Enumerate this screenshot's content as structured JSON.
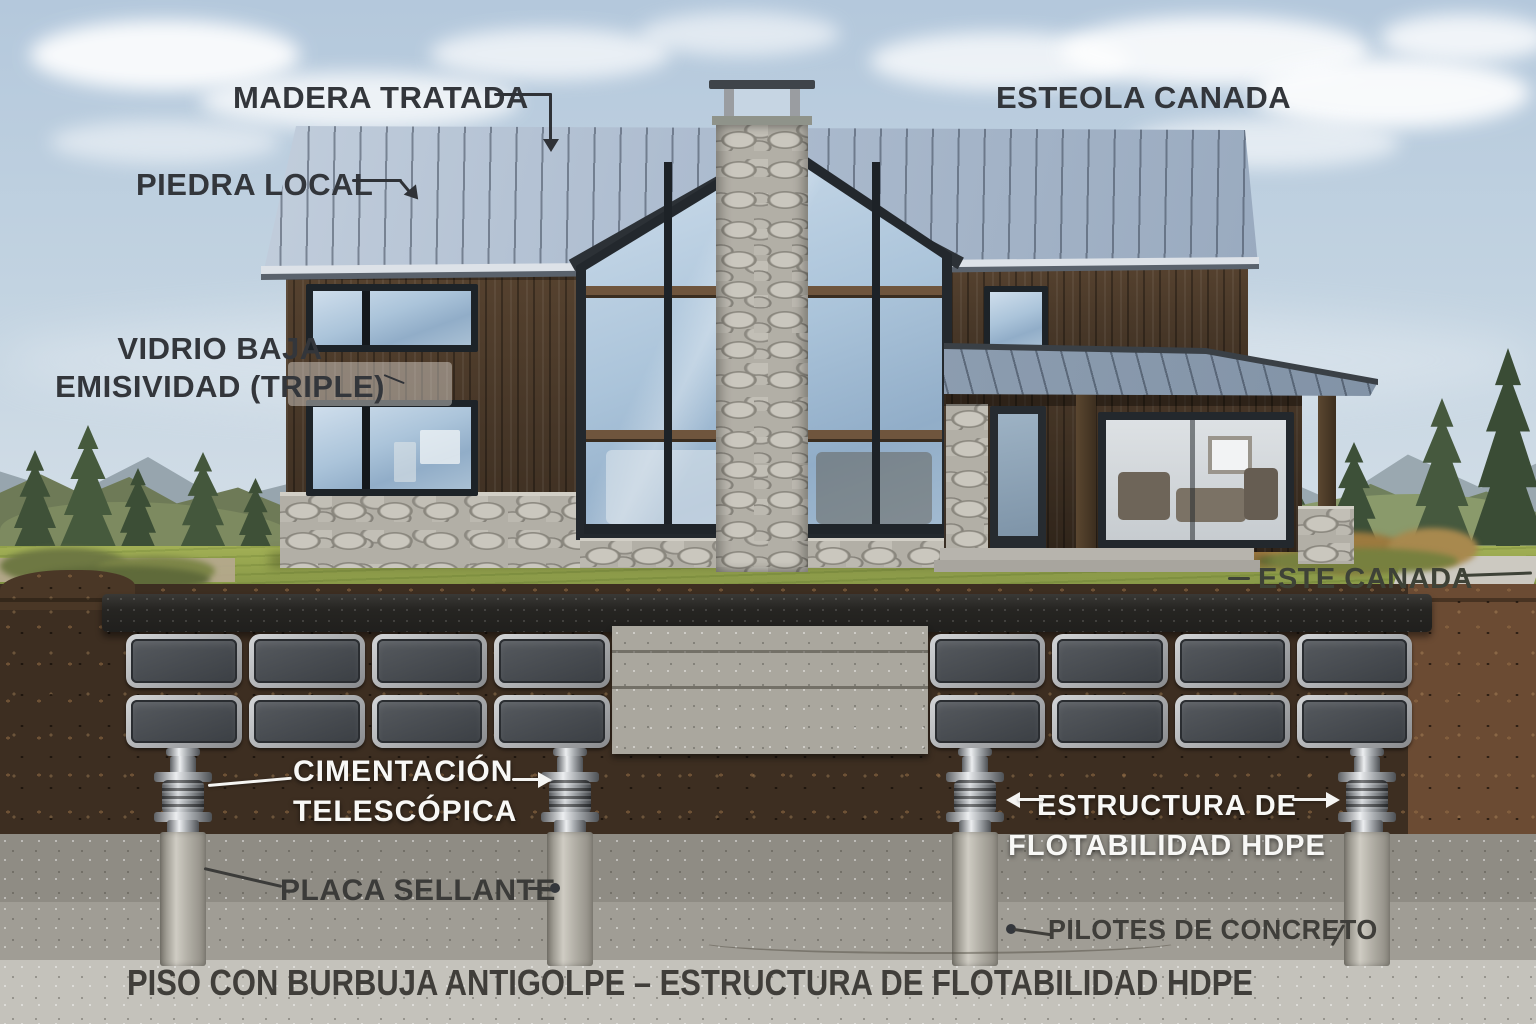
{
  "annotations": {
    "top": {
      "madera": "MADERA TRATADA",
      "piedra": "PIEDRA LOCAL",
      "esteola": "ESTEOLA CANADA"
    },
    "left": {
      "vidrio_line1": "VIDRIO BAJA",
      "vidrio_line2": "EMISIVIDAD (TRIPLE)"
    },
    "ground": {
      "este_canada": "ESTE CANADA",
      "cimentacion_line1": "CIMENTACIÓN",
      "cimentacion_line2": "TELESCÓPICA",
      "estructura_line1": "ESTRUCTURA DE",
      "estructura_line2": "FLOTABILIDAD HDPE",
      "placa": "PLACA SELLANTE",
      "pilotes": "PILOTES DE CONCRETO"
    },
    "caption": "PISO CON BURBUJA ANTIGOLPE – ESTRUCTURA DE FLOTABILIDAD HDPE"
  },
  "colors": {
    "roof_metal": "#a8b8cc",
    "roof_shadow": "#8fa0b6",
    "wood_siding": "#4a3829",
    "stone": "#b2afa6",
    "glass": "#abc4da",
    "grass": "#8d9c4a",
    "soil_dark": "#3d2e21",
    "soil_light": "#6b4b33",
    "concrete": "#a09d95",
    "concrete_light": "#c4c2bb",
    "hdpe_panel_face": "#43474c",
    "hdpe_panel_frame": "#b7b9bb",
    "steel": "#c7cacd",
    "label_dark": "#33363b",
    "label_white": "#f8f8f6"
  }
}
